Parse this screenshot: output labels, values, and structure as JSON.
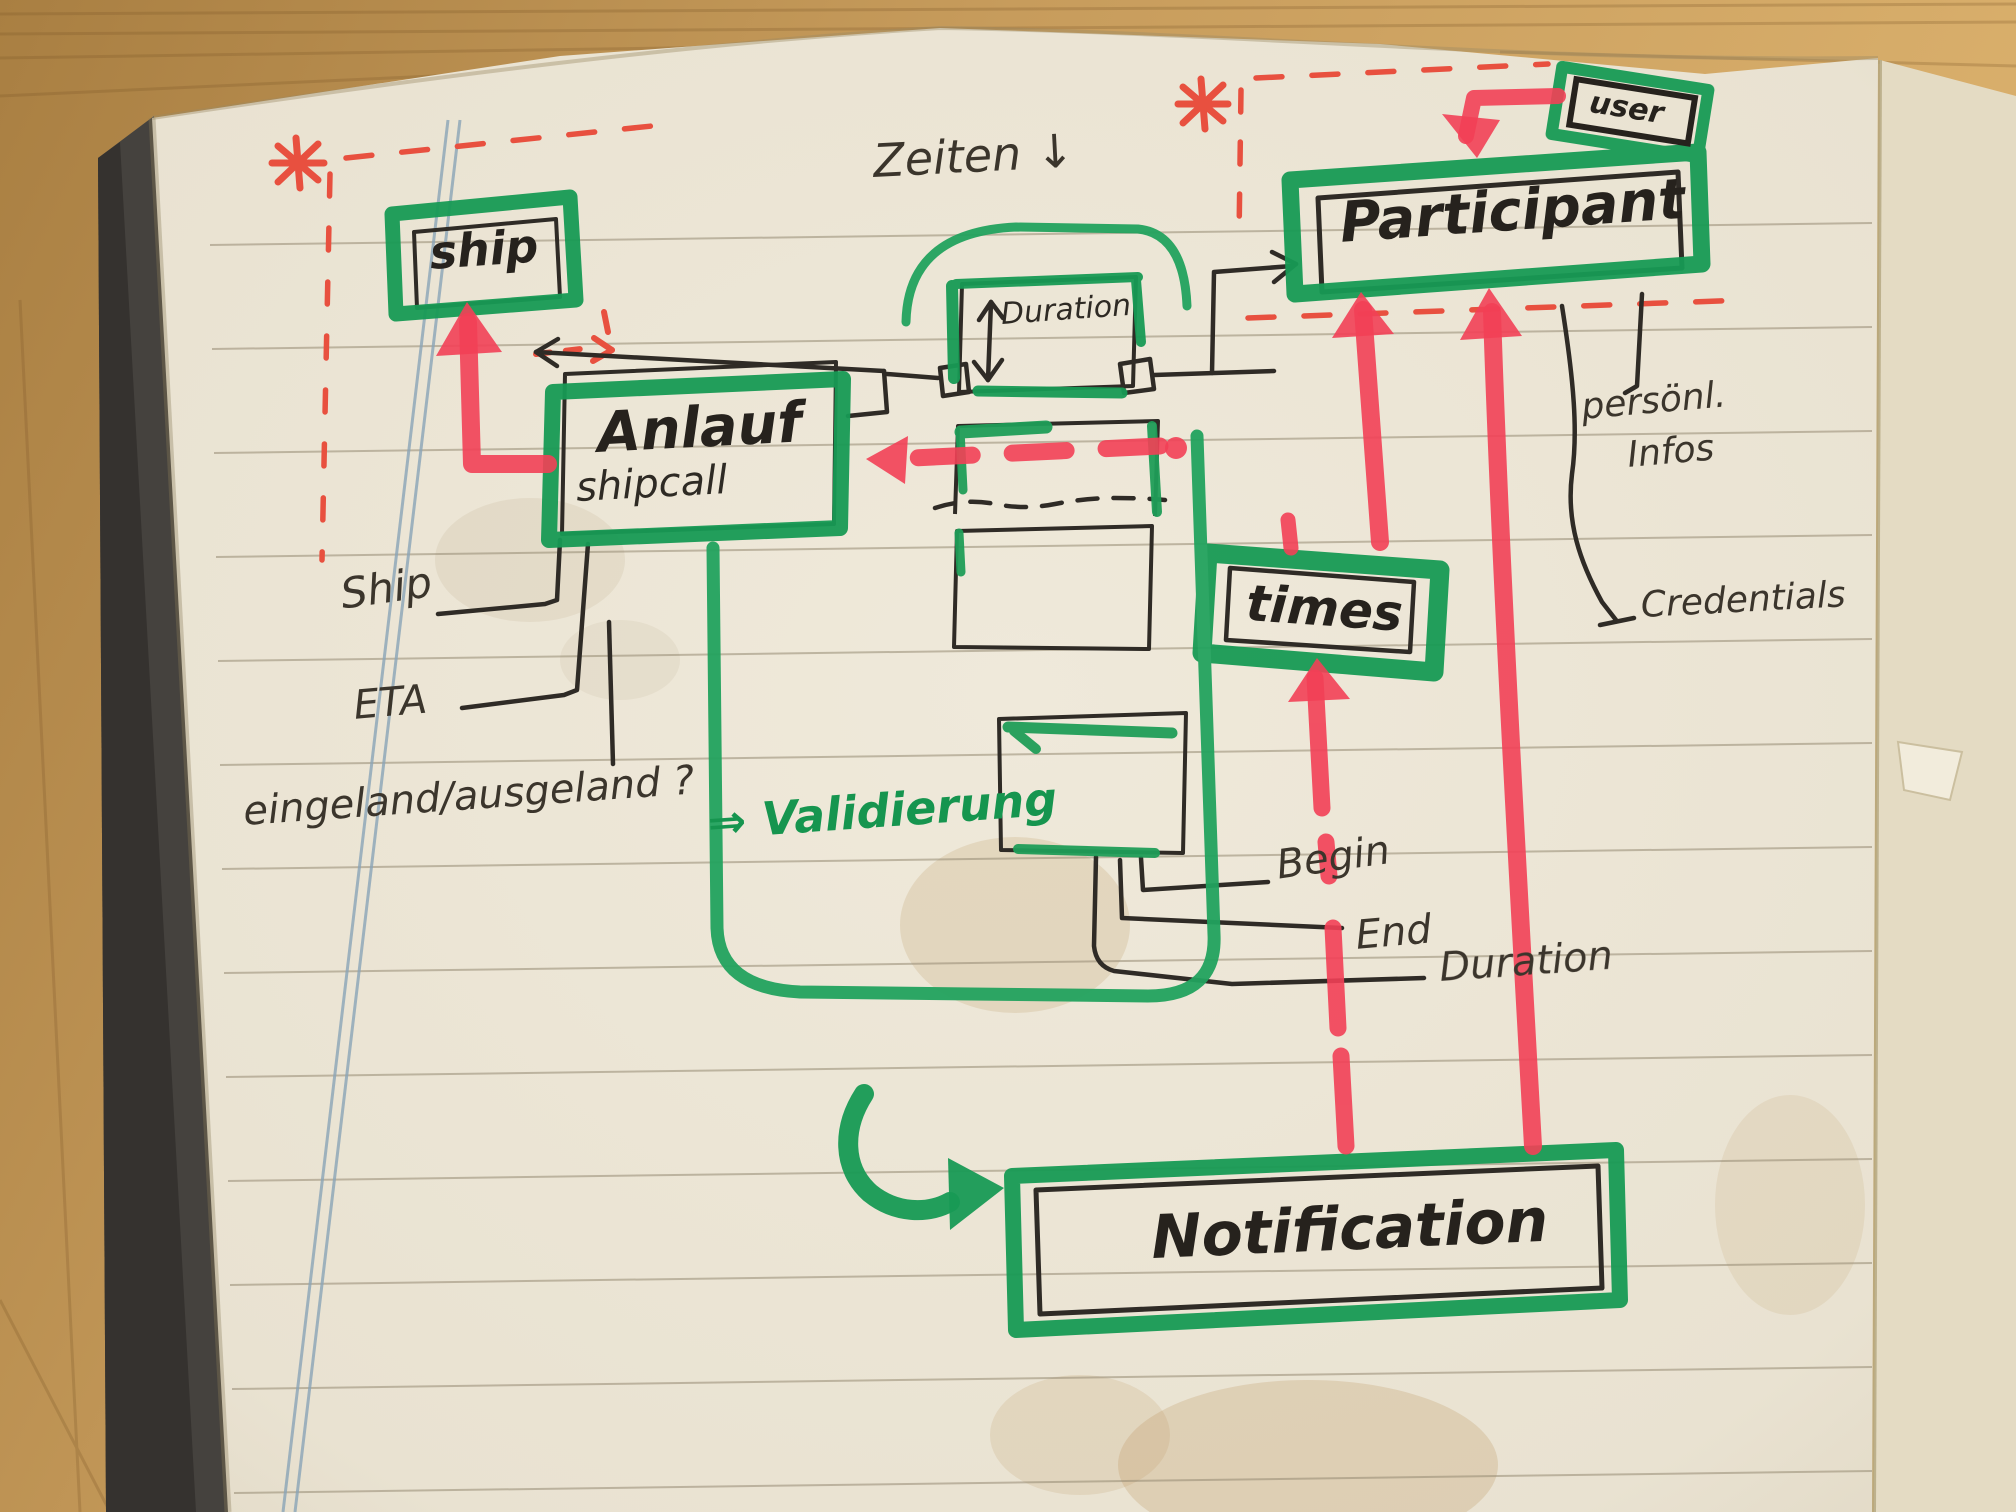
{
  "scene": "hand-drawn data-model diagram on a ruled notebook page, photographed on a wooden table",
  "labels": {
    "ship_box": "ship",
    "anlauf": "Anlauf",
    "shipcall": "shipcall",
    "duration_box": "Duration",
    "times_box": "times",
    "participant_box": "Participant",
    "user_box": "user",
    "notification_box": "Notification",
    "zeiten": "Zeiten ↓",
    "ship_attr": "Ship",
    "eta_attr": "ETA",
    "eingeland_attr": "eingeland/ausgeland ?",
    "begin_attr": "Begin",
    "end_attr": "End",
    "duration_attr": "Duration",
    "personal_attr_line1": "persönl.",
    "personal_attr_line2": "Infos",
    "credentials_attr": "Credentials",
    "validierung": "⇒ Validierung",
    "asterisk_left": "*",
    "asterisk_right": "*"
  },
  "icons": {
    "asterisk_left": "asterisk",
    "asterisk_right": "asterisk",
    "zeiten_arrow": "arrow-down",
    "validierung_arrow": "double-arrow-right",
    "green_hook": "hook-arrow-right",
    "duration_span": "vertical-double-arrow"
  },
  "colors": {
    "marker_green": "#189a55",
    "marker_red": "#f24057",
    "pen_red": "#e8503f",
    "pen_black": "#2f2b26",
    "pencil_text": "#3b352c",
    "page": "#ebe5d6",
    "second_page": "#e4dbc3",
    "margin_blue": "#8aa4b6",
    "wood": "#c49a5c",
    "spine": "#45423e"
  }
}
